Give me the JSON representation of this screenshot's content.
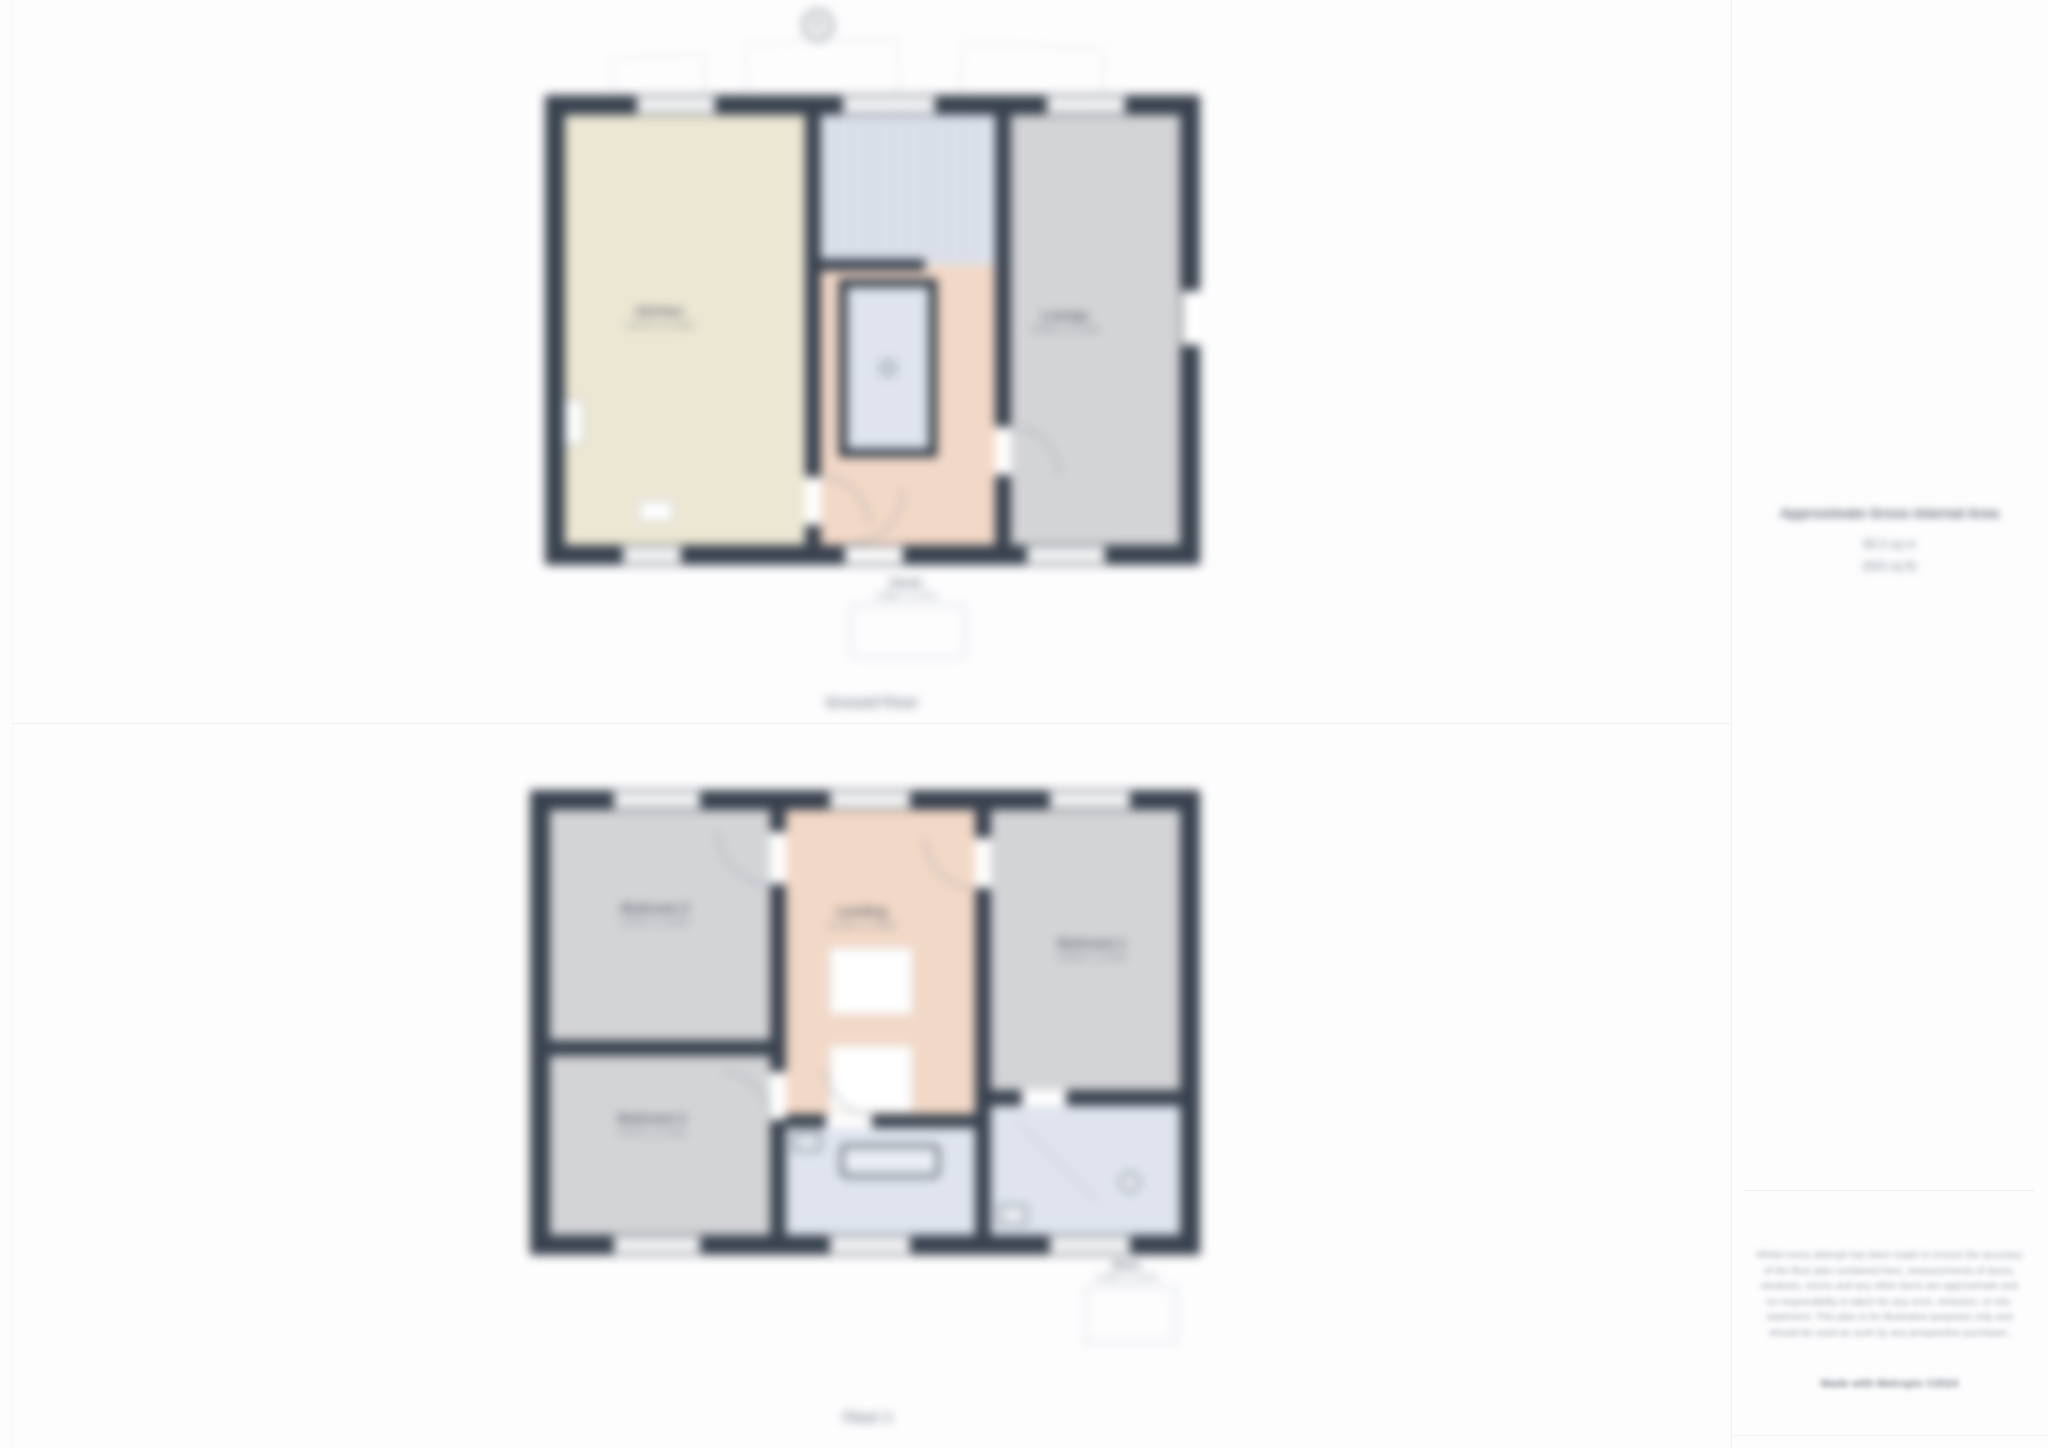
{
  "page": {
    "captions": {
      "ground_floor": "Ground Floor",
      "first_floor": "Floor 1"
    },
    "compass_label": "N"
  },
  "ground_floor": {
    "rooms": {
      "kitchen": {
        "name": "Kitchen",
        "dims": "2.87m x 5.23m"
      },
      "lounge": {
        "name": "Lounge",
        "dims": "3.66m x 5.23m"
      }
    },
    "annex": {
      "name": "Porch",
      "dims": "1.98m x 1.07m"
    }
  },
  "first_floor": {
    "rooms": {
      "bedroom1": {
        "name": "Bedroom 1",
        "dims": "3.66m x 3.20m"
      },
      "bedroom2": {
        "name": "Bedroom 2",
        "dims": "2.87m x 2.62m"
      },
      "bedroom3": {
        "name": "Bedroom 3",
        "dims": "2.87m x 2.13m"
      },
      "landing": {
        "name": "Landing",
        "dims": "2.13m x 3.05m"
      }
    },
    "annex": {
      "name": "Store",
      "dims": "1.40m x 1.07m"
    }
  },
  "sidebar": {
    "area_title": "Approximate Gross Internal Area",
    "area_metric": "85.5 sq m",
    "area_imperial": "(920 sq ft)",
    "disclaimer": "Whilst every attempt has been made to ensure the accuracy of the floor plan contained here, measurements of doors, windows, rooms and any other items are approximate and no responsibility is taken for any error, omission, or mis-statement. This plan is for illustrative purposes only and should be used as such by any prospective purchaser.",
    "credit": "Made with Metropix ©2024"
  },
  "colors": {
    "wall": "#39424f",
    "kitchen_fill": "#ece7d3",
    "room_gray_fill": "#d3d4d6",
    "hall_salmon_fill": "#f2d8c6",
    "wet_blue_fill": "#dfe4ee"
  }
}
